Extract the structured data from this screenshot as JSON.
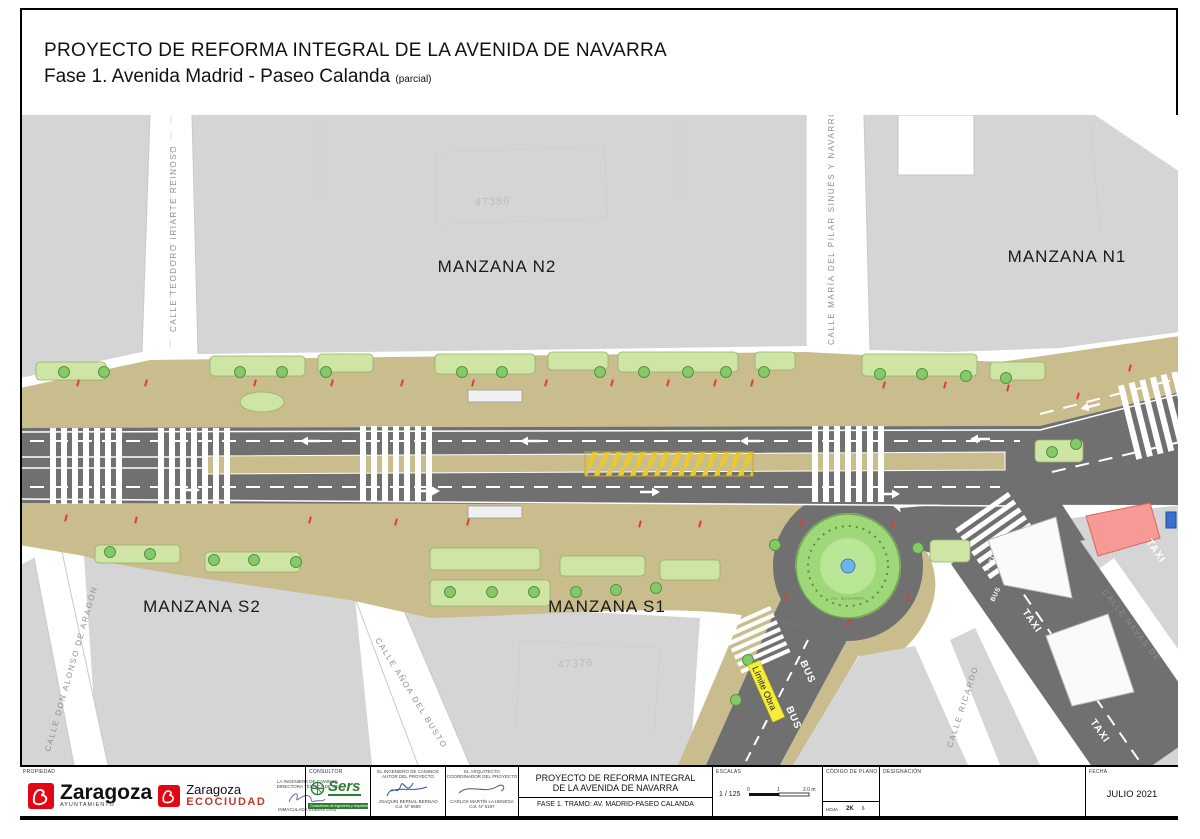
{
  "header": {
    "title": "PROYECTO DE REFORMA INTEGRAL DE LA AVENIDA DE NAVARRA",
    "subtitle": "Fase 1. Avenida Madrid - Paseo Calanda",
    "subtitle_note": "(parcial)"
  },
  "plan": {
    "block_n2": "MANZANA N2",
    "block_n1": "MANZANA N1",
    "block_s2": "MANZANA S2",
    "block_s1": "MANZANA S1",
    "parcel_north": "47386",
    "parcel_south": "47376",
    "street_teodoro": "CALLE TEODORO IRIARTE REINOSO",
    "street_pilar": "CALLE MARÍA DEL PILAR SINUÉS Y NAVARRO",
    "street_alonso": "CALLE DON ALONSO DE ARAGÓN",
    "street_anoa": "CALLE AÑOA DEL BUSTO",
    "street_ricardo": "CALLE RICARDO",
    "street_navas": "CALLE NAVAS DE",
    "limite_obra": "Límite Obra",
    "taxi": "TAXI",
    "bus": "BUS",
    "roundabout_label": "AV. NAVARRA"
  },
  "titleblock": {
    "propiedad_label": "PROPIEDAD",
    "ayto_name": "Zaragoza",
    "ayto_sub": "AYUNTAMIENTO",
    "eco_name": "Zaragoza",
    "eco_sub": "ECOCIUDAD",
    "ingeniera_title_1": "LA INGENIERA DE CAMINOS",
    "ingeniera_title_2": "DIRECTORA TÉCNICA DE SZ",
    "ingeniera_name": "INMACULADA SUBÍAS DÍAZ",
    "consultor_label": "CONSULTOR",
    "sers_name": "Sers",
    "sers_sub": "Consultores de Ingeniería y Arquitectura, S.A.",
    "ingeniero_title_1": "EL INGENIERO DE CAMINOS",
    "ingeniero_title_2": "AUTOR DEL PROYECTO",
    "ingeniero_name": "JOAQUÍN BERNAL BERNAO",
    "ingeniero_col": "Col. Nº 9980",
    "arquitecto_title_1": "EL ARQUITECTO",
    "arquitecto_title_2": "COORDINADOR DEL PROYECTO",
    "arquitecto_name": "CARLOS MARTÍN LA HENEDA",
    "arquitecto_col": "Col. Nº 5197",
    "project_line1": "PROYECTO DE REFORMA INTEGRAL",
    "project_line2": "DE LA AVENIDA DE NAVARRA",
    "project_line3": "FASE 1. TRAMO: AV. MADRID-PASEO CALANDA",
    "escalas_label": "ESCALAS",
    "escala_value": "1 / 125",
    "scale_0": "0",
    "scale_1": "1",
    "scale_2": "2.0 m",
    "codigo_label": "CÓDIGO DE PLANO",
    "hoja_label": "HOJA",
    "hoja_value": "2K",
    "hoja_num": "6",
    "designacion_label": "DESIGNACIÓN",
    "fecha_label": "FECHA",
    "fecha_value": "JULIO 2021"
  },
  "colors": {
    "zaragoza_red": "#e30613",
    "sers_green": "#2e7d32",
    "limite_yellow": "#f4ee3b",
    "road_gray": "#707070",
    "block_gray": "#d5d5d5",
    "sidewalk_tan": "#c9bd8e",
    "garden_green": "#cfe5a5",
    "accent_red_mark": "#e23b32"
  }
}
